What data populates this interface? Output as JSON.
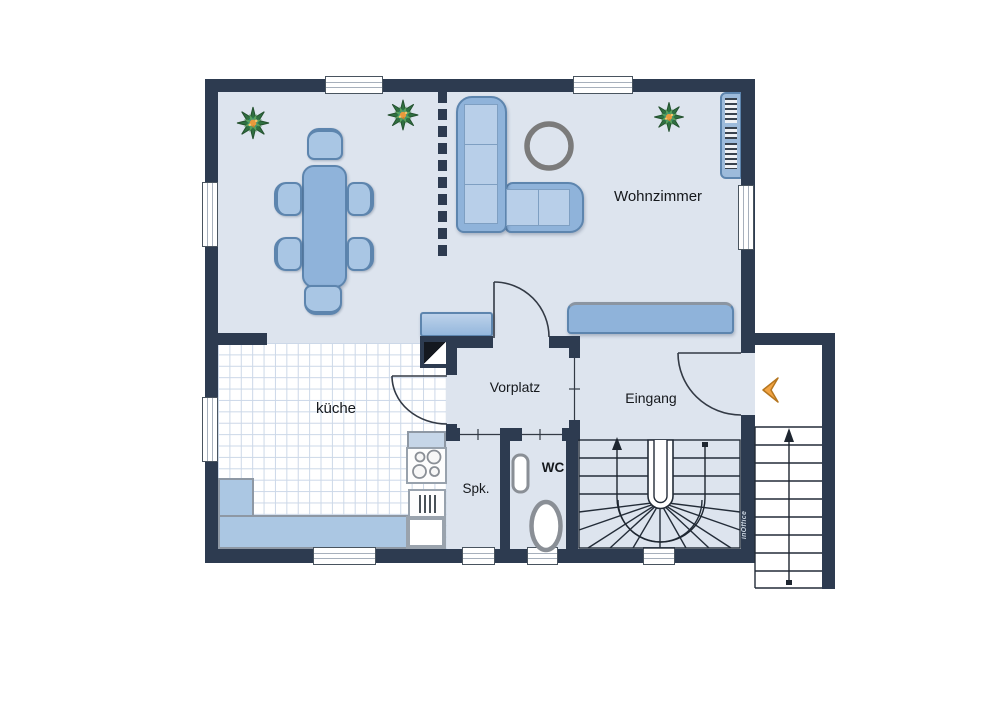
{
  "plan": {
    "title": "Erdgeschoss Grundriss",
    "rooms": {
      "wohnzimmer": {
        "label": "Wohnzimmer"
      },
      "kueche": {
        "label": "küche"
      },
      "vorplatz": {
        "label": "Vorplatz"
      },
      "eingang": {
        "label": "Eingang"
      },
      "spk": {
        "label": "Spk."
      },
      "wc": {
        "label": "WC"
      }
    },
    "branding": {
      "logo": "inOffice"
    },
    "colors": {
      "wall": "#2d3b50",
      "floor": "#dde4ee",
      "tile_line": "#ccd8e8",
      "furniture": "#8fb3da",
      "furniture_light": "#b8cfe9",
      "counter": "#abc7e3",
      "fixture_gray": "#8a8f96",
      "accent_arrow": "#f2a444",
      "plant_green": "#2f7040",
      "plant_orange": "#e89a3c"
    }
  }
}
